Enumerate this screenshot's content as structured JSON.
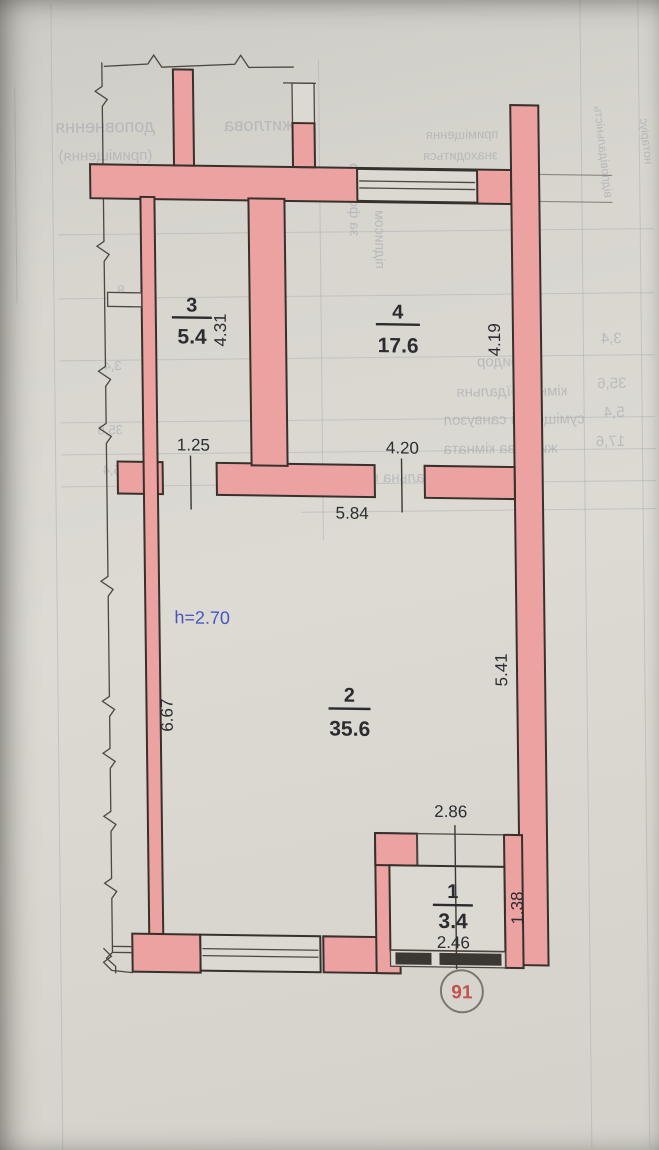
{
  "plan": {
    "unit_number": "91",
    "height_note": "h=2.70",
    "rooms": [
      {
        "number": "1",
        "area": "3.4",
        "dims": {
          "top": "2.86",
          "bottom": "2.46",
          "right": "1.38"
        }
      },
      {
        "number": "2",
        "area": "35.6",
        "dims": {
          "top": "5.84",
          "left": "6.67",
          "right": "5.41"
        }
      },
      {
        "number": "3",
        "area": "5.4",
        "dims": {
          "bottom": "1.25",
          "right": "4.31"
        }
      },
      {
        "number": "4",
        "area": "17.6",
        "dims": {
          "bottom": "4.20",
          "right": "4.19"
        }
      }
    ]
  },
  "colors": {
    "wall_fill": "#eda2a2",
    "wall_outline": "#37312c",
    "ink": "#2c2b2f",
    "height_note_blue": "#4456c2",
    "unit_number_red": "#c1554b",
    "paper": "#dbd9d2"
  },
  "bleedthrough_fragments": [
    "житлова",
    "доповнення",
    "(приміщення)",
    "приміщення",
    "знаходиться",
    "за формою",
    "підписом",
    "коридор",
    "3,4",
    "кімната-їдальня",
    "35,6",
    "суміщений санвузол",
    "5,4",
    "житлова кімната",
    "17,6",
    "загальна площа",
    "відповідальність",
    "нотаріус",
    "8",
    "3,4",
    "35,6",
    "5,4"
  ]
}
